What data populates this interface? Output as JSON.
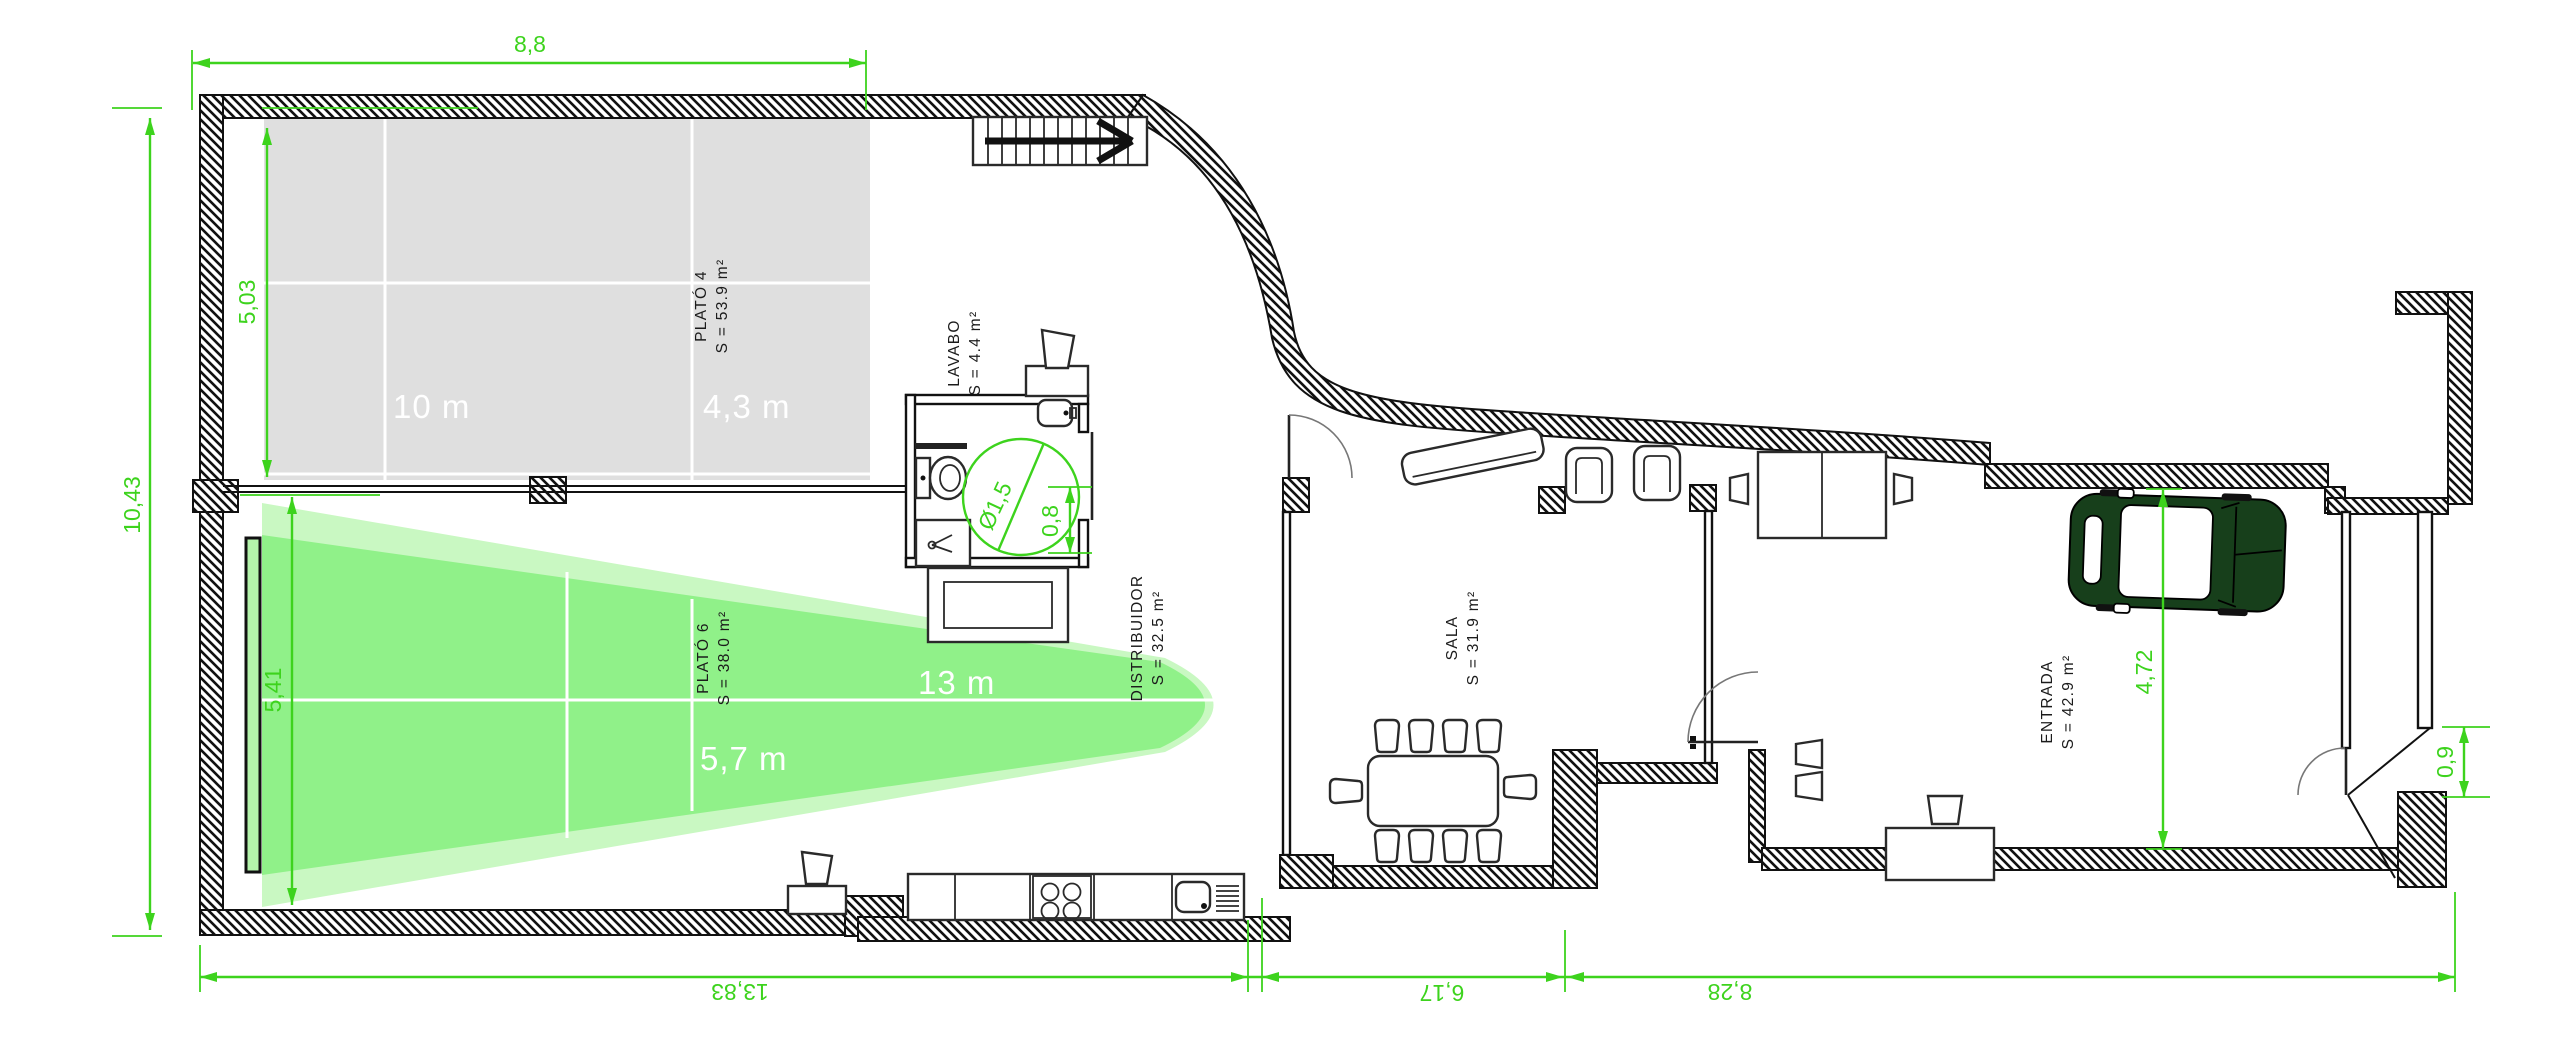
{
  "drawing_type": "floor-plan",
  "rooms": {
    "plato4": {
      "name": "PLATÓ 4",
      "area": "S = 53.9 m²"
    },
    "plato6": {
      "name": "PLATÓ 6",
      "area": "S = 38.0 m²"
    },
    "lavabo": {
      "name": "LAVABO",
      "area": "S = 4.4 m²"
    },
    "distribuidor": {
      "name": "DISTRIBUIDOR",
      "area": "S = 32.5 m²"
    },
    "sala": {
      "name": "SALA",
      "area": "S = 31.9 m²"
    },
    "entrada": {
      "name": "ENTRADA",
      "area": "S = 42.9 m²"
    }
  },
  "overlays": {
    "plato4_width": "10 m",
    "plato4_depth": "4,3 m",
    "plato6_length": "13 m",
    "plato6_width": "5,7 m"
  },
  "dimensions": {
    "top_width": "8,8",
    "left_height_total": "10,43",
    "plato4_height": "5,03",
    "plato6_height": "5,41",
    "bottom_left": "13,83",
    "bottom_middle": "6,17",
    "bottom_right": "8,28",
    "entrada_height": "4,72",
    "turning_circle_diameter": "Ø1,5",
    "wc_clearance": "0,8",
    "entry_door_width": "0,9"
  },
  "colors": {
    "dim": "#3dd31d",
    "cone": "#90f189",
    "coneLight": "#c9f8c2",
    "screen": "#b4f3ab",
    "gray": "#dfdfdf",
    "car": "#173f1b"
  }
}
